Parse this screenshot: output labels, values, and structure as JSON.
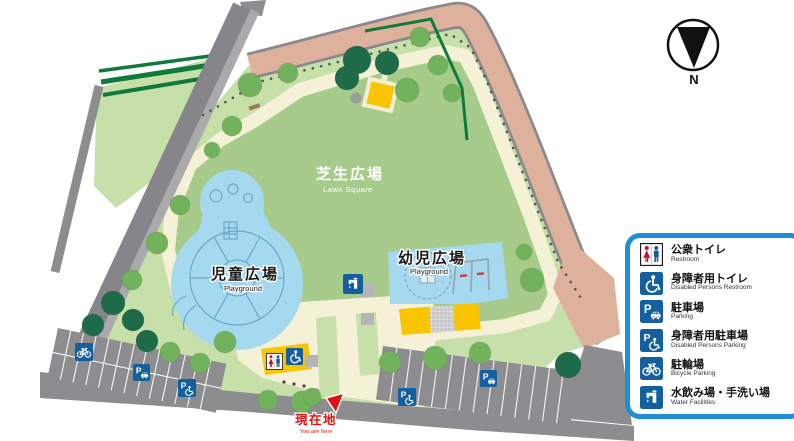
{
  "map": {
    "areas": {
      "lawn": {
        "ja": "芝生広場",
        "en": "Lawn Square"
      },
      "children_plaza": {
        "ja": "児童広場",
        "en": "Playground"
      },
      "toddler_plaza": {
        "ja": "幼児広場",
        "en": "Playground"
      }
    },
    "current_location": {
      "ja": "現在地",
      "en": "You are here"
    },
    "compass": {
      "label": "N"
    }
  },
  "legend": {
    "items": [
      {
        "icon": "restroom-icon",
        "ja": "公衆トイレ",
        "en": "Restroom"
      },
      {
        "icon": "disabled-restroom-icon",
        "ja": "身障者用トイレ",
        "en": "Disabled Persons Restroom"
      },
      {
        "icon": "parking-icon",
        "ja": "駐車場",
        "en": "Parking"
      },
      {
        "icon": "disabled-parking-icon",
        "ja": "身障者用駐車場",
        "en": "Disabled Persons Parking"
      },
      {
        "icon": "bicycle-parking-icon",
        "ja": "駐輪場",
        "en": "Bicycle Parking"
      },
      {
        "icon": "water-facilities-icon",
        "ja": "水飲み場・手洗い場",
        "en": "Water Facilities"
      }
    ]
  },
  "colors": {
    "legend_border_blue": "#1e8fd5",
    "sign_blue": "#14609e",
    "restroom_female_red": "#c8102e",
    "restroom_male_blue": "#1c5a96",
    "park_green": "#c7dfa9",
    "lawn_green": "#a6cb8b",
    "path_cream": "#f4f1d7",
    "water_blue": "#a5d9ef",
    "road_gray": "#8d8d90",
    "road_pink": "#ddb19c",
    "tree_green": "#72b25c",
    "tree_dark_green": "#1e6b4a",
    "hedge_green": "#0e7a3b",
    "structure_yellow": "#f9c500",
    "marker_red": "#e01010"
  }
}
